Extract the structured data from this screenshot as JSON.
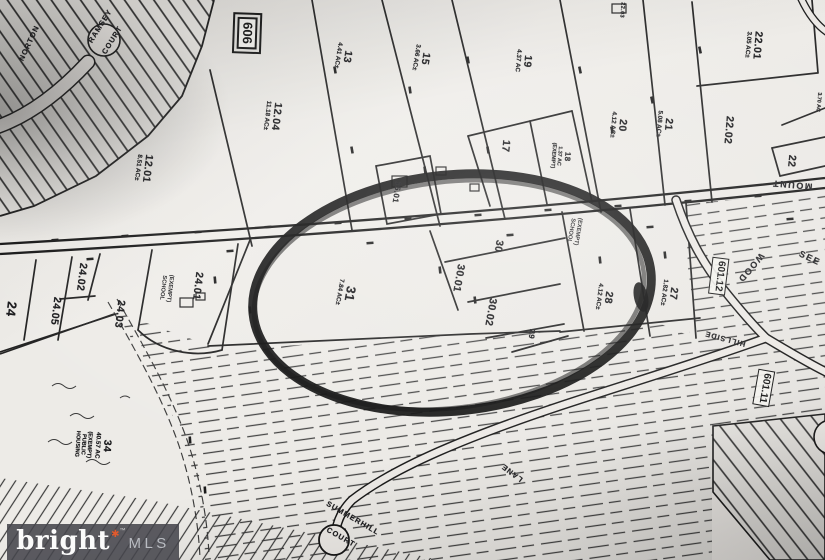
{
  "map_title": "Tax parcel plat map photo with hand-drawn highlight circle",
  "colors": {
    "paper": "#ebe9e5",
    "ink": "#1c1c1c",
    "highlight_circle": "#0a0a0a",
    "watermark_bg": "#46464c",
    "watermark_brand": "#fbfbfb",
    "watermark_mls": "#b9bcc2",
    "watermark_star": "#e15a2d"
  },
  "shields": {
    "route_606": "606",
    "route_601_12": "601.12",
    "route_601_11": "601.11"
  },
  "roads": {
    "norton": "NORTON",
    "ramsey_line1": "RAMSEY",
    "ramsey_line2": "COURT",
    "mount": "MOUNT",
    "wood": "WOOD",
    "see": "SEE",
    "hillside": "HILLSIDE",
    "lane": "LANE",
    "summerhill": "SUMMERHILL",
    "summerhill_court": "COURT"
  },
  "notes": {
    "school_center": "(EXEMPT) SCHOOL",
    "school_24": "(EXEMPT) SCHOOL"
  },
  "parcels": [
    {
      "id": "12.04",
      "area": "11.18 AC±"
    },
    {
      "id": "12.01",
      "area": "8.51 AC±"
    },
    {
      "id": "13",
      "area": "4.41 AC±"
    },
    {
      "id": "15",
      "area": "3.66 AC±"
    },
    {
      "id": "19",
      "area": "4.37 AC"
    },
    {
      "id": "17"
    },
    {
      "id": "18",
      "area": "1.37 AC",
      "note": "(EXEMPT)"
    },
    {
      "id": "20",
      "area": "4.12 AC±"
    },
    {
      "id": "21",
      "area": "5.08 AC±"
    },
    {
      "id": "22.01",
      "area": "3.05 AC±"
    },
    {
      "id": "22.02"
    },
    {
      "id": "22"
    },
    {
      "id": "22.03"
    },
    {
      "id": "15.01"
    },
    {
      "id": "30"
    },
    {
      "id": "30.01"
    },
    {
      "id": "30.02"
    },
    {
      "id": "29"
    },
    {
      "id": "28",
      "area": "4.12 AC±"
    },
    {
      "id": "27",
      "area": "1.82 AC±"
    },
    {
      "id": "31",
      "area": "7.84 AC±"
    },
    {
      "id": "24.01"
    },
    {
      "id": "24.02"
    },
    {
      "id": "24.03"
    },
    {
      "id": "24.05"
    },
    {
      "id": "24"
    },
    {
      "id": "34",
      "area": "40.57 AC",
      "note": "(EXEMPT) PUBLIC HOUSING"
    },
    {
      "area": "3.70 AC"
    }
  ],
  "watermark": {
    "brand": "bright",
    "star": "✱",
    "tm": "™",
    "mls": "MLS"
  }
}
